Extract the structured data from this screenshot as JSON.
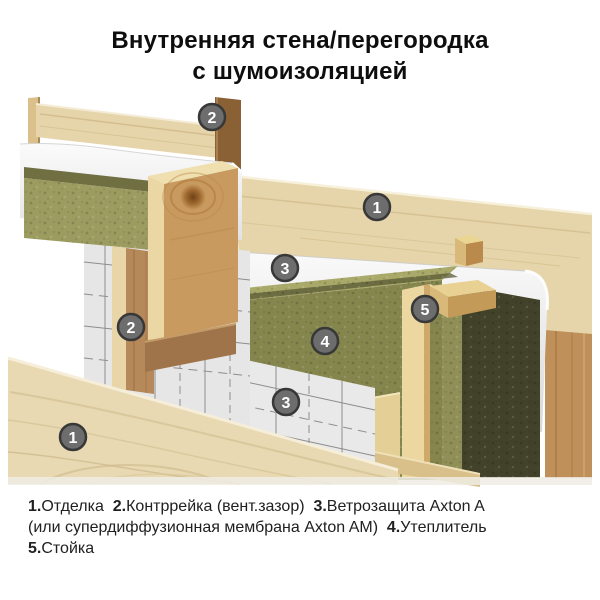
{
  "title": {
    "line1": "Внутренняя стена/перегородка",
    "line2": "с шумоизоляцией"
  },
  "legend": {
    "items": [
      {
        "num": "1",
        "label": "Отделка"
      },
      {
        "num": "2",
        "label": "Контррейка (вент.зазор)"
      },
      {
        "num": "3",
        "label": "Ветрозащита Axton A (или супердиффузионная мембрана Axton AM)"
      },
      {
        "num": "4",
        "label": "Утеплитель"
      },
      {
        "num": "5",
        "label": "Стойка"
      }
    ],
    "lines": [
      "1.Отделка  2.Контррейка (вент.зазор)  3.Ветрозащита Axton A",
      "(или супердиффузионная мембрана Axton AM)  4.Утеплитель",
      "5.Стойка"
    ]
  },
  "diagram": {
    "description": "Cutaway isometric view of an interior partition wall with sound insulation",
    "badges": [
      {
        "label": "2",
        "x": 212,
        "y": 117,
        "part": "counter-batten"
      },
      {
        "label": "1",
        "x": 377,
        "y": 207,
        "part": "finish-board"
      },
      {
        "label": "3",
        "x": 285,
        "y": 268,
        "part": "wind-protection-membrane"
      },
      {
        "label": "5",
        "x": 425,
        "y": 309,
        "part": "stud"
      },
      {
        "label": "2",
        "x": 131,
        "y": 327,
        "part": "counter-batten"
      },
      {
        "label": "4",
        "x": 325,
        "y": 341,
        "part": "insulation"
      },
      {
        "label": "3",
        "x": 286,
        "y": 402,
        "part": "wind-protection-membrane"
      },
      {
        "label": "1",
        "x": 73,
        "y": 437,
        "part": "finish-board"
      }
    ],
    "colors": {
      "badge_fill": "#6d6d6d",
      "badge_ring": "#383838",
      "badge_text": "#ffffff",
      "wood_pale": "#e6d5aa",
      "wood_mid": "#d9c497",
      "wood_warm": "#c0905a",
      "wood_dark": "#8a6134",
      "stud_cream": "#ecd7a0",
      "wool_light": "#a9a96a",
      "wool_mid": "#85854e",
      "wool_dark": "#42422a",
      "membrane": "#f3f3f3",
      "membrane_shade": "#dcdcdc",
      "grid_line": "#8d8d8d"
    }
  }
}
